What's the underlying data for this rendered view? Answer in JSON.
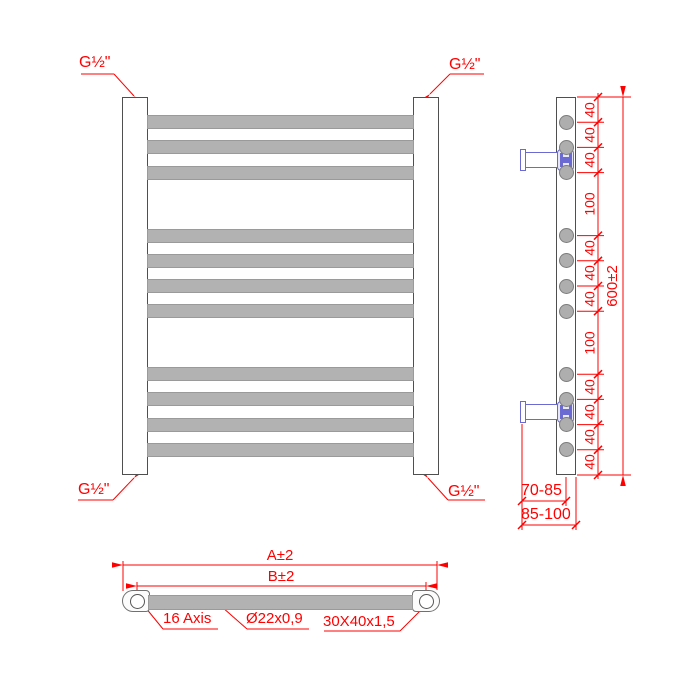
{
  "front_view": {
    "fitting_labels": {
      "top_left": "G½\"",
      "top_right": "G½\"",
      "bottom_left": "G½\"",
      "bottom_right": "G½\""
    }
  },
  "side_view": {
    "chain_mm": [
      40,
      40,
      40,
      100,
      40,
      40,
      40,
      100,
      40,
      40,
      40,
      40
    ],
    "chain_labels": [
      "40",
      "40",
      "40",
      "100",
      "40",
      "40",
      "40",
      "100",
      "40",
      "40",
      "40",
      "40"
    ],
    "overall_height_label": "600±2",
    "wall_to_axis_label": "70-85",
    "wall_to_face_label": "85-100",
    "valve_positions_mm": [
      100,
      500
    ],
    "tube_count": 11
  },
  "bottom_view": {
    "overall_width_label": "A±2",
    "axis_to_axis_label": "B±2",
    "axis_leader_label": "16 Axis",
    "tube_spec_label": "Ø22x0,9",
    "profile_spec_label": "30X40x1,5"
  },
  "colors": {
    "dimension_red": "#ff0000",
    "tube_gray": "#b2b2b2",
    "tube_border": "#9a9a9a",
    "rail_border": "#4f4f4f",
    "valve_blue": "#6a6ad2"
  }
}
